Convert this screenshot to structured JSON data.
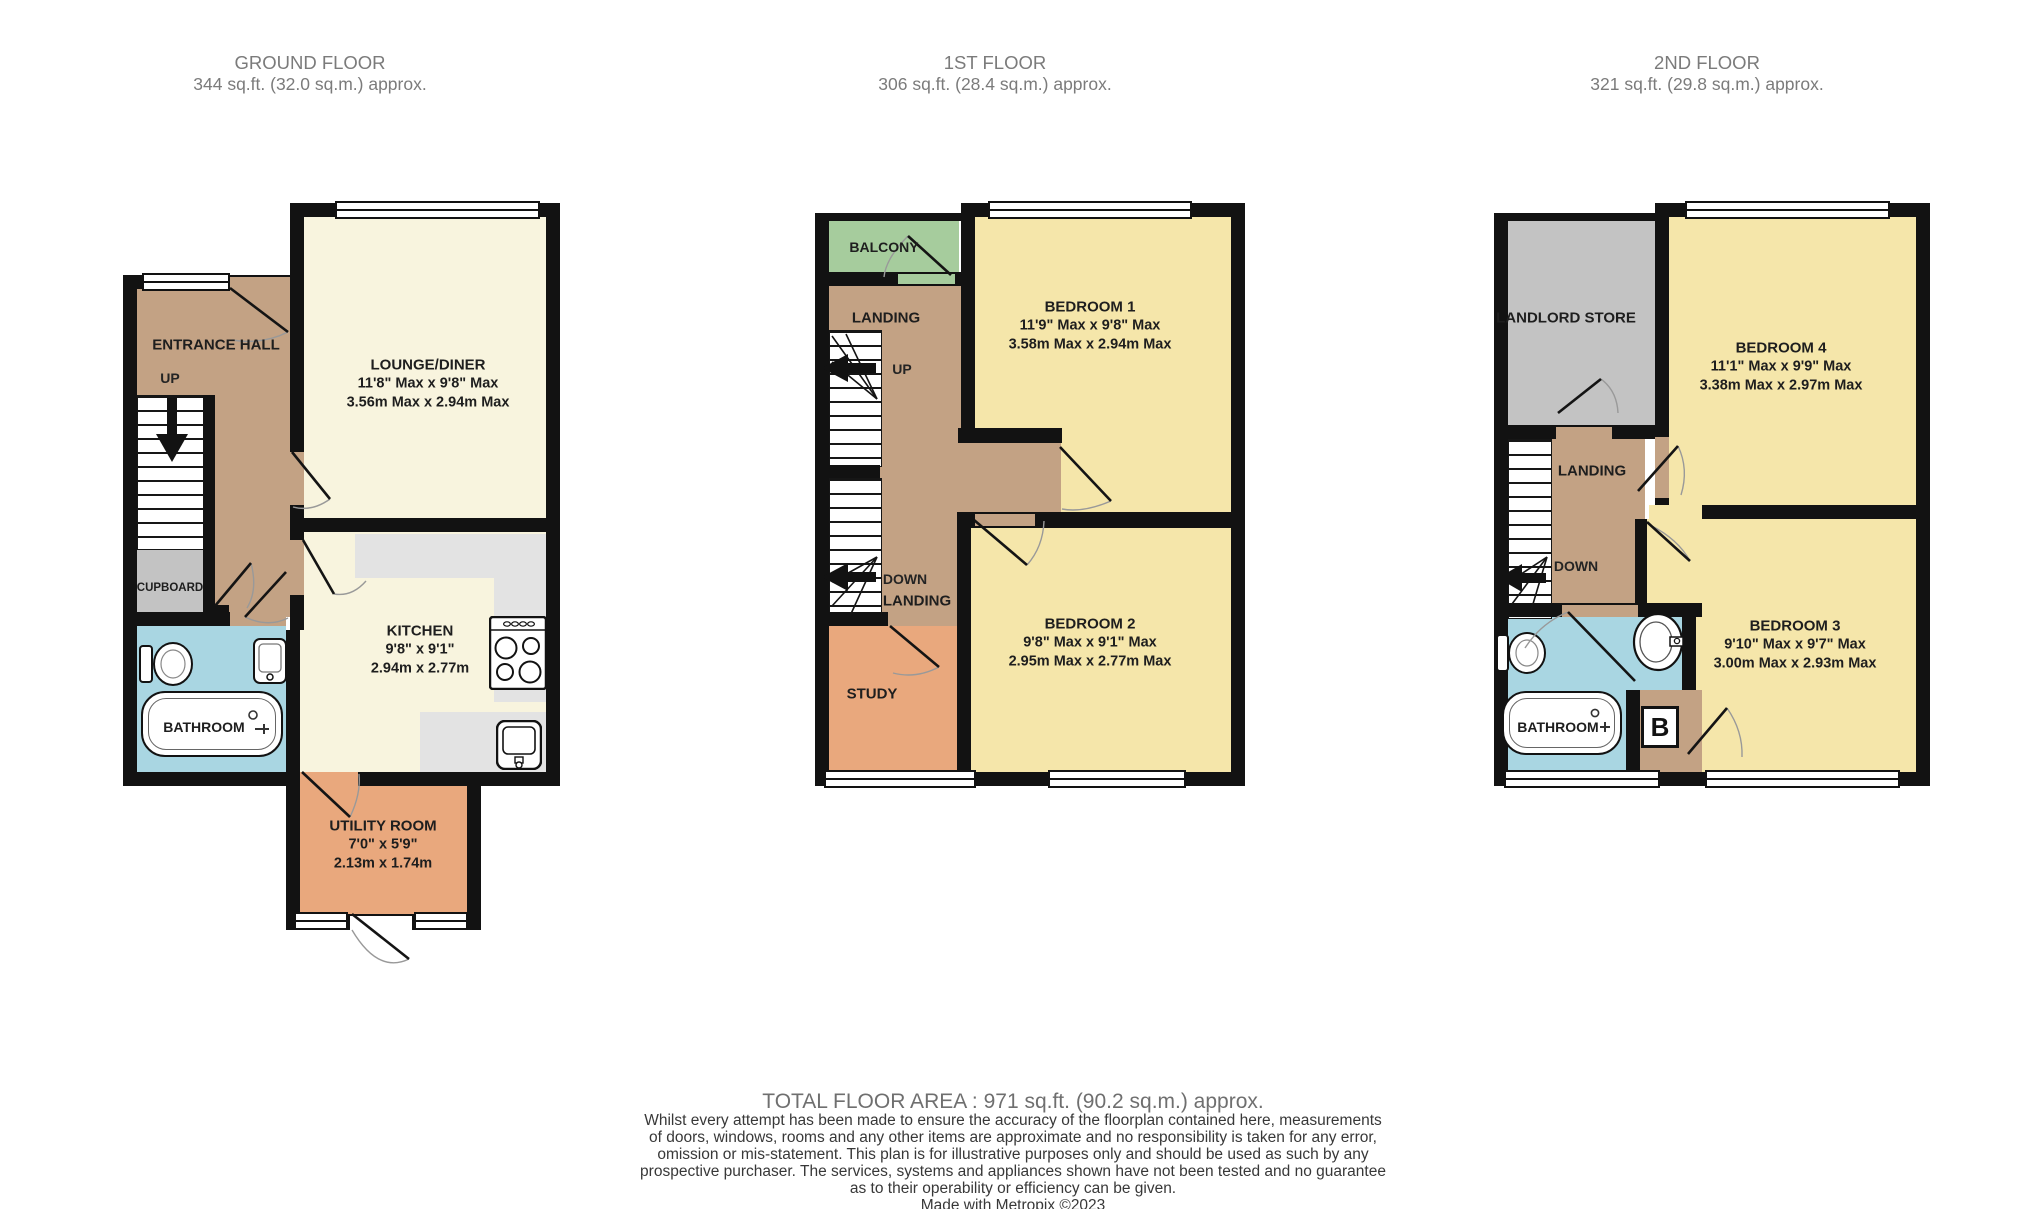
{
  "colors": {
    "wall": "#121212",
    "cream": "#f8f4de",
    "bedroom_yellow": "#f5e6aa",
    "hall_tan": "#c3a284",
    "study_orange": "#e9a87d",
    "store_gray": "#c3c3c3",
    "bathroom_blue": "#a9d6e2",
    "balcony_green": "#a6cc9d",
    "counter_gray": "#e3e3e3",
    "header_text": "#7b7b7b",
    "room_text": "#1e1e1e"
  },
  "floors": [
    {
      "title": "GROUND FLOOR",
      "subtitle": "344 sq.ft. (32.0 sq.m.) approx.",
      "rooms": {
        "entrance_hall": {
          "name": "ENTRANCE HALL"
        },
        "lounge": {
          "name": "LOUNGE/DINER",
          "imperial": "11'8\" Max x 9'8\" Max",
          "metric": "3.56m Max x 2.94m Max"
        },
        "cupboard": {
          "name": "CUPBOARD"
        },
        "bathroom": {
          "name": "BATHROOM"
        },
        "kitchen": {
          "name": "KITCHEN",
          "imperial": "9'8\"  x 9'1\"",
          "metric": "2.94m  x 2.77m"
        },
        "utility": {
          "name": "UTILITY ROOM",
          "imperial": "7'0\"  x 5'9\"",
          "metric": "2.13m  x 1.74m"
        }
      },
      "stairs": {
        "up": "UP"
      }
    },
    {
      "title": "1ST FLOOR",
      "subtitle": "306 sq.ft. (28.4 sq.m.) approx.",
      "rooms": {
        "balcony": {
          "name": "BALCONY"
        },
        "landing_upper": {
          "name": "LANDING"
        },
        "bedroom1": {
          "name": "BEDROOM 1",
          "imperial": "11'9\" Max x 9'8\" Max",
          "metric": "3.58m Max x 2.94m Max"
        },
        "landing_lower": {
          "name": "LANDING"
        },
        "study": {
          "name": "STUDY"
        },
        "bedroom2": {
          "name": "BEDROOM 2",
          "imperial": "9'8\" Max x 9'1\" Max",
          "metric": "2.95m Max x 2.77m Max"
        }
      },
      "stairs": {
        "up": "UP",
        "down": "DOWN"
      }
    },
    {
      "title": "2ND FLOOR",
      "subtitle": "321 sq.ft. (29.8 sq.m.) approx.",
      "rooms": {
        "landlord_store": {
          "name": "LANDLORD STORE"
        },
        "bedroom4": {
          "name": "BEDROOM 4",
          "imperial": "11'1\" Max x 9'9\" Max",
          "metric": "3.38m Max x 2.97m Max"
        },
        "landing": {
          "name": "LANDING"
        },
        "bathroom": {
          "name": "BATHROOM"
        },
        "bedroom3": {
          "name": "BEDROOM 3",
          "imperial": "9'10\" Max x 9'7\" Max",
          "metric": "3.00m Max x 2.93m Max"
        },
        "boiler": {
          "label": "B"
        }
      },
      "stairs": {
        "down": "DOWN"
      }
    }
  ],
  "footer": {
    "total": "TOTAL FLOOR AREA : 971 sq.ft. (90.2 sq.m.) approx.",
    "disclaimer": "Whilst every attempt has been made to ensure the accuracy of the floorplan contained here, measurements\nof doors, windows, rooms and any other items are approximate and no responsibility is taken for any error,\nomission or mis-statement. This plan is for illustrative purposes only and should be used as such by any\nprospective purchaser. The services, systems and appliances shown have not been tested and no guarantee\nas to their operability or efficiency can be given.",
    "credit": "Made with Metropix ©2023"
  }
}
